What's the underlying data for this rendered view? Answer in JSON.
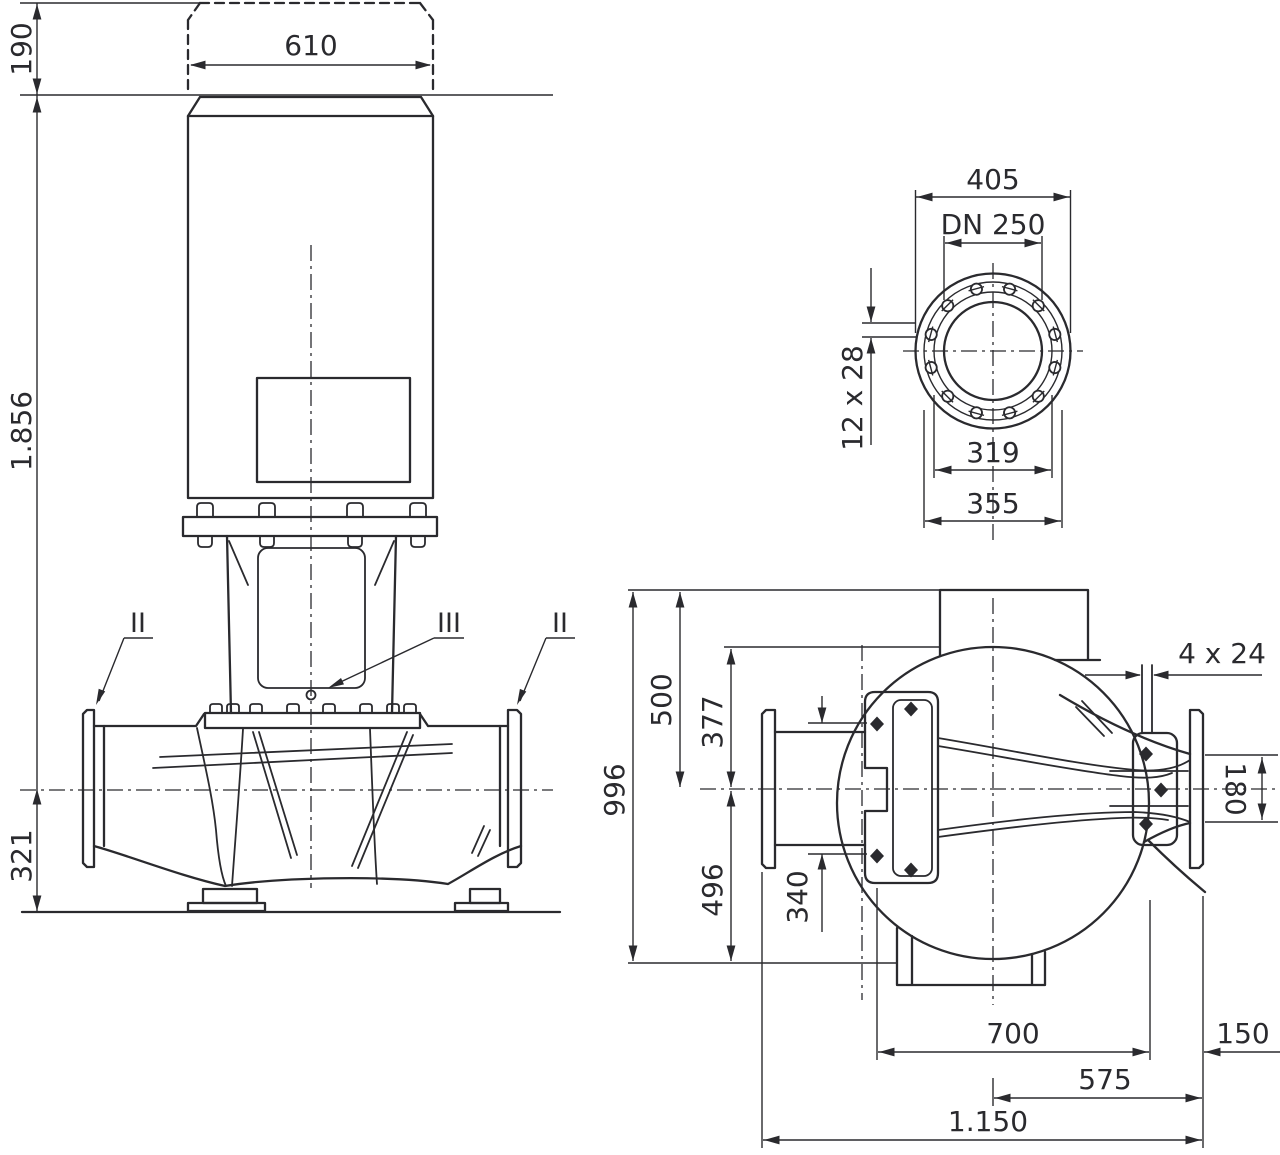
{
  "drawing": {
    "background": "#ffffff",
    "line_color": "#2a2a2e",
    "elevation": {
      "motor_margin_height": "190",
      "motor_width": "610",
      "total_height": "1.856",
      "axis_to_base_height": "321",
      "section_left": "II",
      "section_mid": "III",
      "section_right": "II"
    },
    "flange_view": {
      "outer_diameter": "405",
      "nominal_diameter": "DN 250",
      "bolt_holes": "12 x 28",
      "raised_face_diameter": "319",
      "bolt_circle_diameter": "355"
    },
    "plan_view": {
      "overall_height": "996",
      "top_to_axis": "500",
      "volute_top_to_axis": "377",
      "axis_to_bottom": "496",
      "bolt_span_vertical": "340",
      "foot_slots": "4 x 24",
      "discharge_bore": "180",
      "foot_bolt_span": "700",
      "foot_to_flange": "150",
      "axis_to_discharge_face": "575",
      "overall_length": "1.150"
    }
  }
}
